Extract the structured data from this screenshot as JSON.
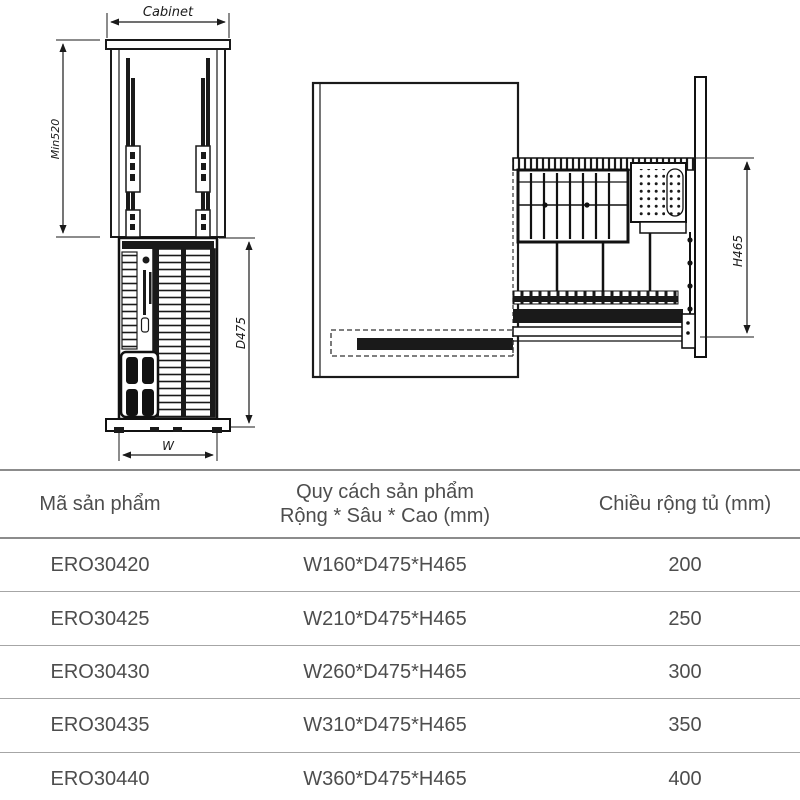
{
  "diagram": {
    "front_view": {
      "top_dim_label": "Cabinet",
      "left_dim_label": "Min520",
      "right_dim_label": "D475",
      "bottom_dim_label": "W"
    },
    "side_view": {
      "right_dim_label": "H465"
    }
  },
  "table": {
    "columns": {
      "product_code": "Mã sản phẩm",
      "spec_line1": "Quy cách sản phẩm",
      "spec_line2": "Rộng * Sâu * Cao (mm)",
      "cabinet_width": "Chiều rộng tủ (mm)"
    },
    "rows": [
      {
        "code": "ERO30420",
        "size": "W160*D475*H465",
        "width": "200"
      },
      {
        "code": "ERO30425",
        "size": "W210*D475*H465",
        "width": "250"
      },
      {
        "code": "ERO30430",
        "size": "W260*D475*H465",
        "width": "300"
      },
      {
        "code": "ERO30435",
        "size": "W310*D475*H465",
        "width": "350"
      },
      {
        "code": "ERO30440",
        "size": "W360*D475*H465",
        "width": "400"
      }
    ]
  },
  "colors": {
    "drawing_line": "#1a1a1a",
    "table_text": "#4d4d4d",
    "table_border": "#a6a6a6",
    "background": "#ffffff"
  }
}
